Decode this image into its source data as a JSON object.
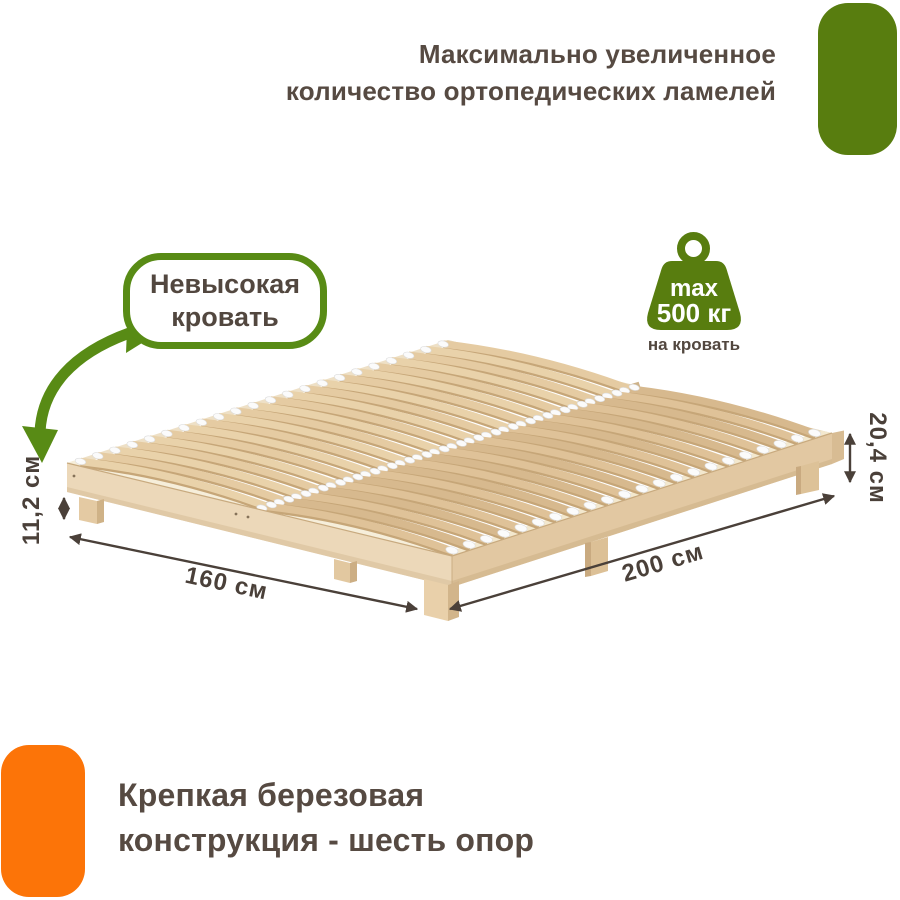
{
  "page": {
    "width": 900,
    "height": 900,
    "background": "#ffffff"
  },
  "colors": {
    "brand_green": "#587d0f",
    "callout_green": "#588b15",
    "accent_orange": "#fc7408",
    "heading_text": "#564a42",
    "dimension_text": "#4a4039",
    "wood_light": "#e9d2aa"
  },
  "heading_top": {
    "line1": "Максимально увеличенное",
    "line2": "количество ортопедических ламелей"
  },
  "callout_bubble": {
    "line1": "Невысокая",
    "line2": "кровать"
  },
  "weight_badge": {
    "max_label": "max",
    "value": "500 кг",
    "caption": "на кровать"
  },
  "dimensions": {
    "leg_height": "11,2 см",
    "frame_height": "20,4 см",
    "width": "160 см",
    "length": "200 см"
  },
  "heading_bottom": {
    "line1": "Крепкая березовая",
    "line2": "конструкция - шесть опор"
  }
}
